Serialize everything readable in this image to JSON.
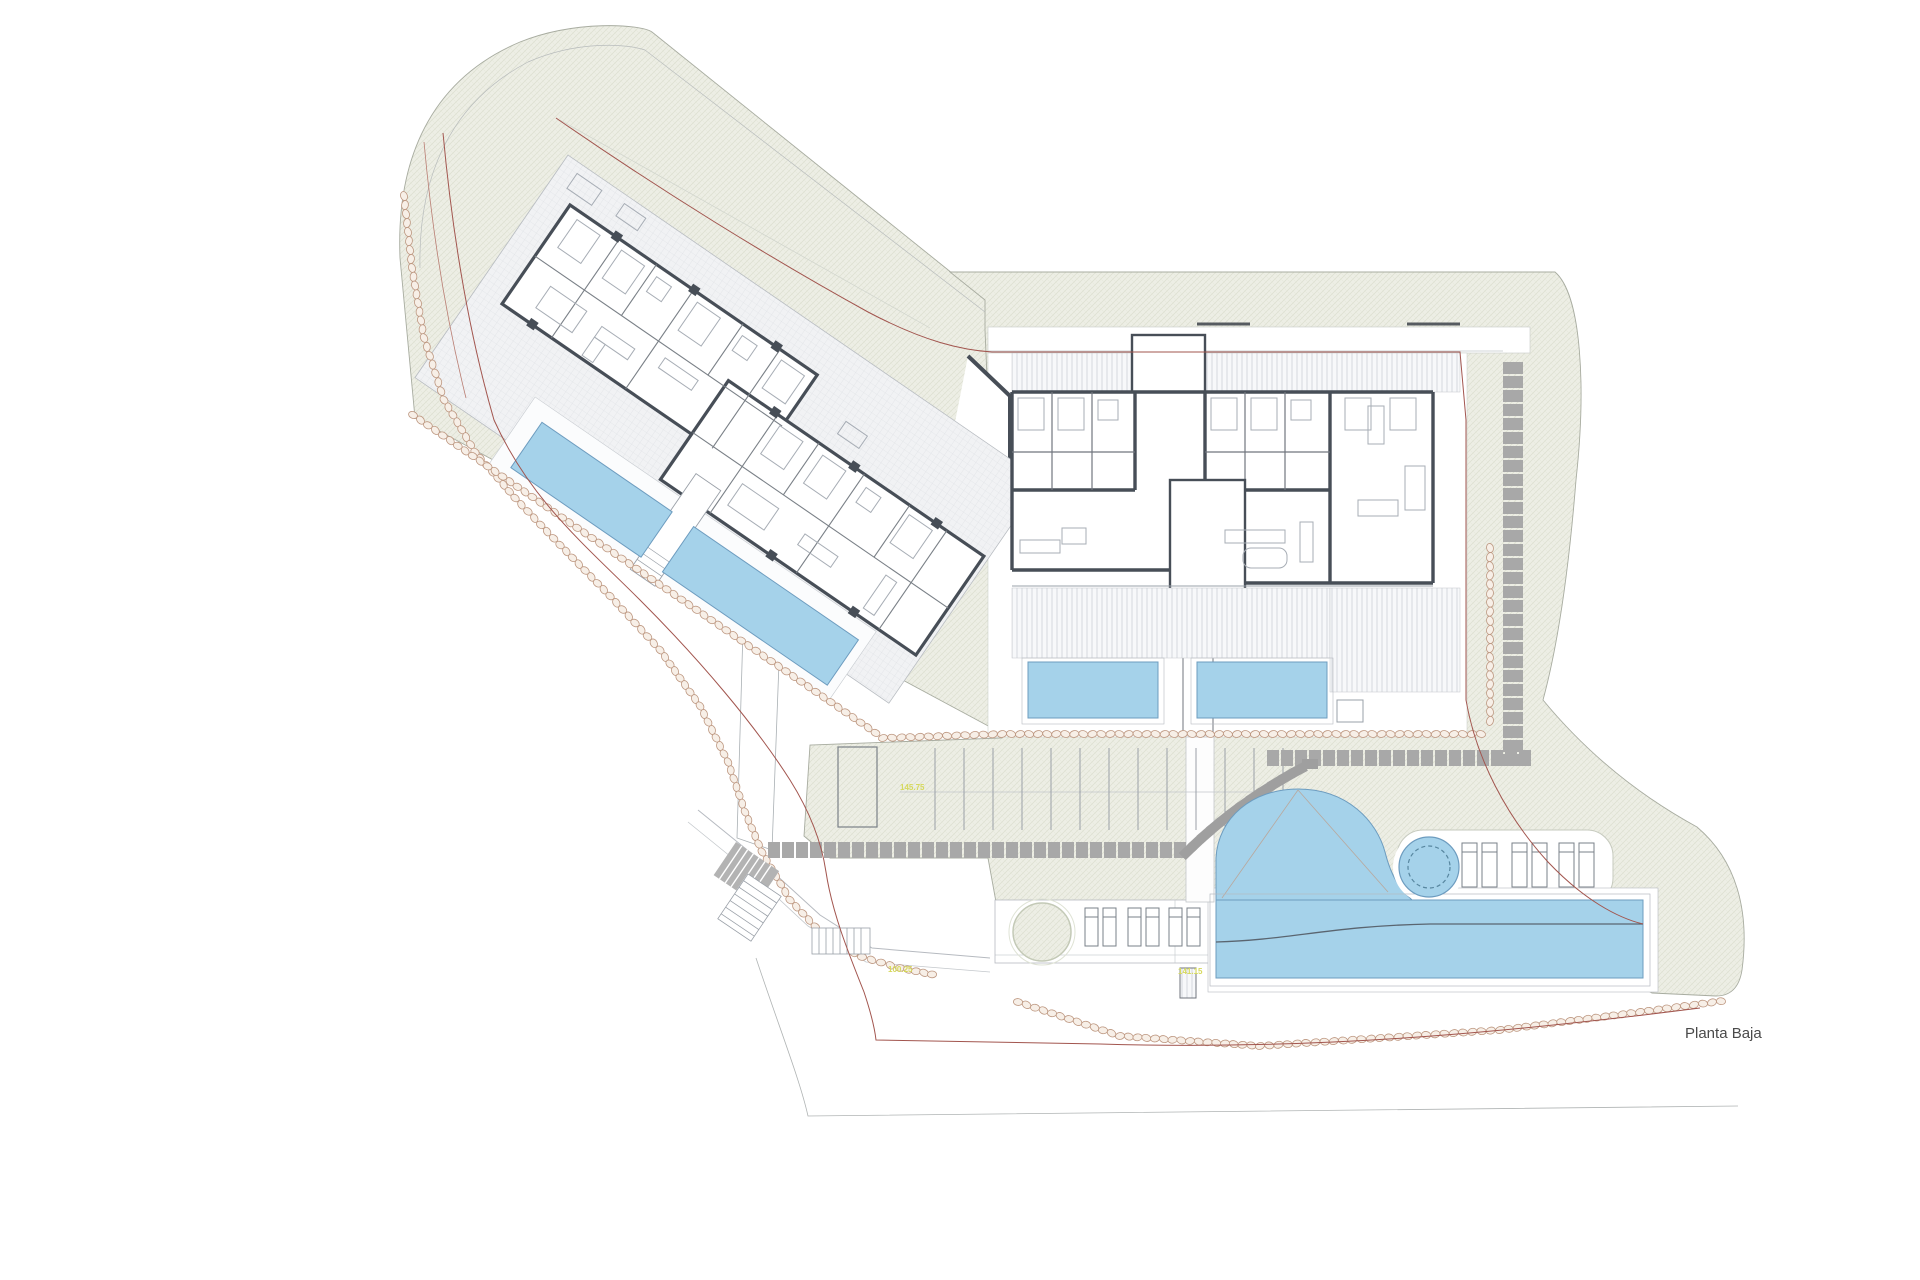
{
  "drawing": {
    "title": "Planta Baja",
    "type": "architectural-site-plan-ground-floor"
  },
  "elevation_markers": [
    {
      "id": "m1",
      "text": "145.75"
    },
    {
      "id": "m2",
      "text": "100.25"
    },
    {
      "id": "m3",
      "text": "141.15"
    }
  ],
  "site": {
    "left_building": {
      "orientation_deg": 34.5,
      "units": 2,
      "private_pools": 2
    },
    "right_building": {
      "orientation_deg": 0,
      "units": 2,
      "private_pools": 2
    },
    "parking": {
      "spaces": 12
    },
    "amenities": {
      "communal_pool": 1,
      "spa_circle": 1,
      "sun_loungers": 12,
      "planter_circles": 1
    }
  },
  "colors": {
    "pool_blue": "#a5d2ea",
    "pool_edge": "#6d9cbf",
    "site_green": "#edeee5",
    "wall_dark": "#474e57",
    "stone_border": "#bd9780",
    "boundary_red": "#a2554e",
    "paver_gray": "#a8a8a8",
    "label_yellow": "#d6d95c",
    "title_gray": "#4a4a4a"
  }
}
